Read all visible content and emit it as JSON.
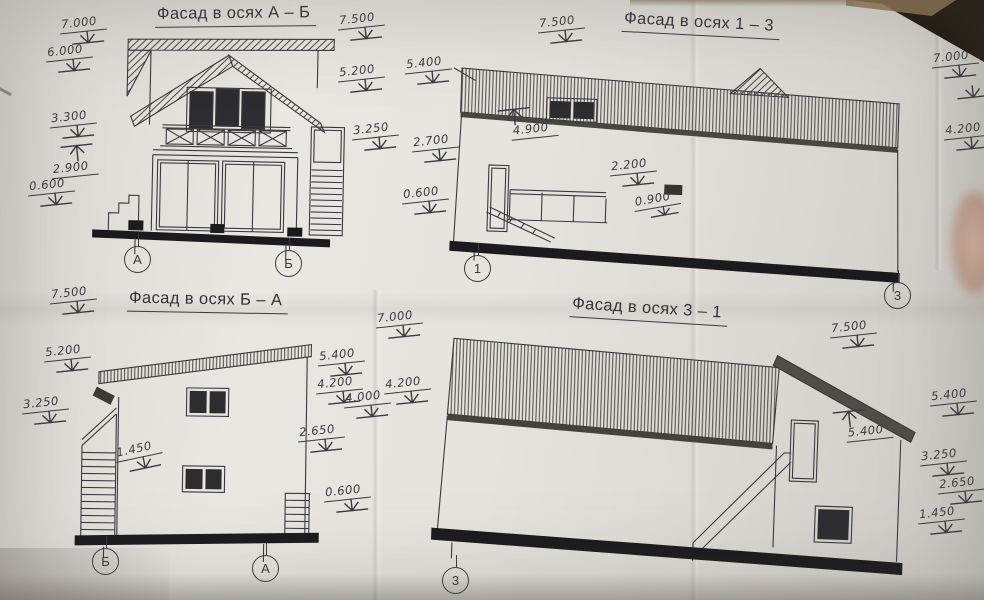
{
  "titles": {
    "ab": "Фасад в осях А – Б",
    "f13": "Фасад в осях 1 – 3",
    "ba": "Фасад в осях Б – А",
    "f31": "Фасад в осях 3 – 1"
  },
  "axes": {
    "ab_left": "А",
    "ab_right": "Б",
    "f13_left": "1",
    "f13_right": "3",
    "ba_left": "Б",
    "ba_right": "А",
    "f31_left": "3"
  },
  "elevations": {
    "ab_left": [
      "7.000",
      "6.000",
      "3.300",
      "2.900",
      "0.600"
    ],
    "ab_mid": [
      "7.500",
      "5.200",
      "3.250"
    ],
    "f13_top": "7.500",
    "f13_left": [
      "5.400",
      "2.700",
      "0.600"
    ],
    "f13_inner": [
      "4.900",
      "2.200",
      "0.900"
    ],
    "f13_right": [
      "7.000",
      "4.200"
    ],
    "ba_top": "7.500",
    "ba_left": [
      "5.200",
      "3.250"
    ],
    "ba_inner": "1.450",
    "mid_bottom": [
      "7.000",
      "5.400",
      "4.200",
      "4.000",
      "4.200",
      "2.650",
      "0.600"
    ],
    "f31_top": "7.500",
    "f31_inner": "5.400",
    "f31_right": [
      "5.400",
      "3.250",
      "2.650",
      "1.450"
    ]
  }
}
